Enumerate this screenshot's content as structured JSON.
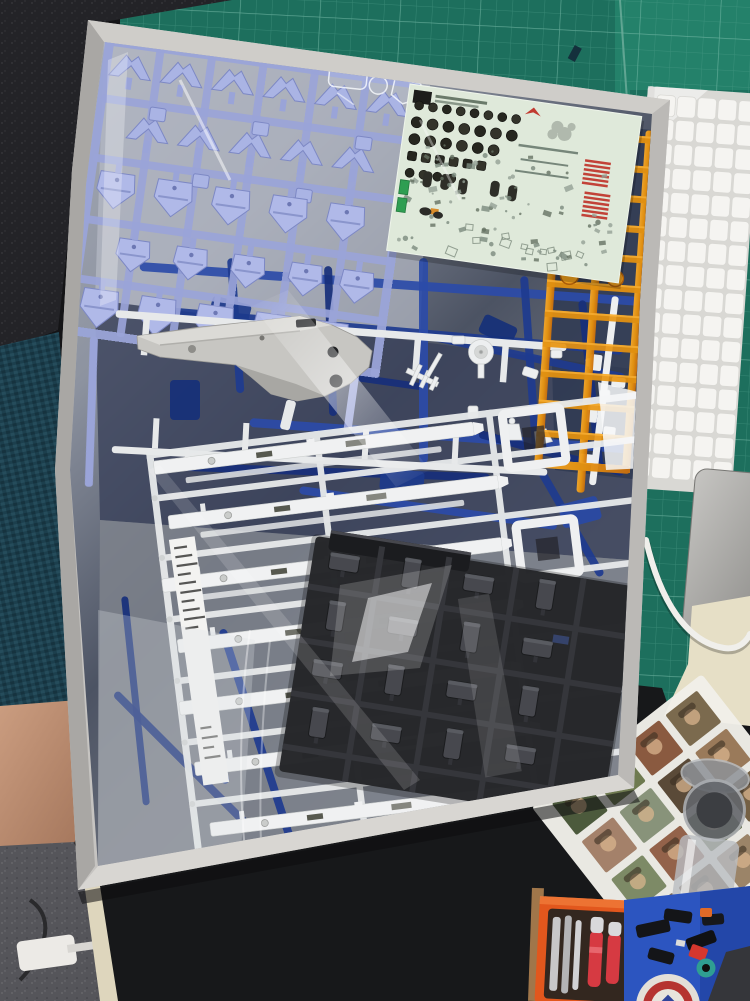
{
  "scene": {
    "alt": "Opened Gundam model kit box with bagged plastic sprues on a desk"
  },
  "palette": {
    "mat": "#1d6f5d",
    "matlight": "#27876f",
    "matline": "#4f9f8c",
    "matmajor": "#8ecab8",
    "box": "#c6c4c1",
    "boxlight": "#d8d6d2",
    "boxdark": "#a9a7a4",
    "boxrim": "#cfcdc9",
    "bag": "#8d93a0",
    "bagdark": "#39415a",
    "baglight": "#b6bbc6",
    "lav": "#9aa4d8",
    "lavlight": "#aab4e4",
    "lavfill": "#b0b9e8",
    "lavdark": "#7d88c4",
    "white": "#f0f1f2",
    "whitedim": "#e7e9ea",
    "whiteshade": "#cdd0cf",
    "gray": "#c7c6c2",
    "graylight": "#dbdad6",
    "graydark": "#a8a7a3",
    "black": "#26272a",
    "blackrail": "#35363b",
    "blackpart": "#47484e",
    "blackhl": "#5e6067",
    "decal": "#dfe9da",
    "decalink": "#2c2c24",
    "decalgray": "#7e8c7e",
    "green": "#2f9e52",
    "red": "#c24238",
    "orange": "#e8940f",
    "orangelight": "#ffb435",
    "orangedark": "#b05f08",
    "kb": "#d9d8d4",
    "key": "#f5f4f1",
    "pad": "#b5b3b0",
    "deskmat": "#17181a",
    "carpet": "#55555a",
    "chair": "#1c3f4d",
    "skin": "#c49579",
    "cream": "#ded6bd",
    "paper": "#e6dfc6",
    "photo": "#f1efe9",
    "toolcase": "#e2571d",
    "toolred": "#d63a42",
    "tray": "#2c55c0",
    "glass": "#b9bdc2",
    "wood": "#a0764a",
    "badgered": "#b53431",
    "badgeblue": "#30449a",
    "teal": "#2f9e92",
    "blues": [
      "#2b4ba8",
      "#1e3b8f",
      "#172f7b"
    ]
  },
  "keyboard": {
    "rows": 16,
    "cols": 5
  },
  "lavender": {
    "frame": {
      "w": 318,
      "h": 300,
      "vrails": [
        52,
        104,
        156,
        208,
        260
      ],
      "hrails": [
        58,
        118,
        180,
        240
      ]
    },
    "rows": [
      {
        "type": "chevron",
        "y": 14,
        "xs": [
          8,
          60,
          112,
          164,
          216,
          268
        ]
      },
      {
        "type": "chevron",
        "y": 74,
        "xs": [
          34,
          86,
          138,
          190,
          242
        ]
      },
      {
        "type": "block",
        "y": 64,
        "xs": [
          54,
          158,
          262
        ]
      },
      {
        "type": "block",
        "y": 124,
        "xs": [
          106,
          210
        ]
      },
      {
        "type": "shield",
        "y": 134,
        "xs": [
          12,
          70,
          128,
          186,
          244
        ],
        "w": 38,
        "h": 36
      },
      {
        "type": "shield",
        "y": 198,
        "xs": [
          40,
          98,
          156,
          214,
          266
        ],
        "w": 34,
        "h": 32
      },
      {
        "type": "shield",
        "y": 252,
        "xs": [
          12,
          70,
          128,
          186,
          244
        ],
        "w": 38,
        "h": 38
      }
    ]
  },
  "blue_bars": [
    [
      140,
      262,
      500,
      4,
      9,
      0
    ],
    [
      155,
      306,
      470,
      5,
      8,
      1
    ],
    [
      185,
      350,
      240,
      8,
      7,
      2
    ],
    [
      420,
      330,
      210,
      12,
      8,
      1
    ],
    [
      250,
      418,
      380,
      4,
      9,
      0
    ],
    [
      160,
      462,
      330,
      2,
      8,
      2
    ],
    [
      235,
      258,
      135,
      86,
      8,
      1
    ],
    [
      332,
      266,
      150,
      88,
      8,
      2
    ],
    [
      428,
      258,
      205,
      90,
      9,
      0
    ],
    [
      528,
      276,
      180,
      86,
      8,
      1
    ],
    [
      586,
      300,
      170,
      84,
      8,
      2
    ],
    [
      180,
      548,
      240,
      78,
      8,
      1
    ],
    [
      128,
      596,
      210,
      84,
      7,
      2
    ],
    [
      226,
      628,
      260,
      72,
      8,
      1
    ],
    [
      300,
      486,
      260,
      8,
      8,
      0
    ],
    [
      118,
      690,
      190,
      45,
      8,
      2
    ],
    [
      545,
      470,
      120,
      60,
      8,
      1
    ],
    [
      480,
      430,
      150,
      15,
      8,
      2
    ]
  ],
  "beams": [
    [
      6,
      10,
      322
    ],
    [
      14,
      66,
      332
    ],
    [
      0,
      128,
      342
    ],
    [
      8,
      190,
      338
    ],
    [
      2,
      252,
      334
    ],
    [
      10,
      314,
      338
    ],
    [
      18,
      376,
      304
    ]
  ],
  "decal_dots": [
    [
      20,
      8,
      4.5
    ],
    [
      37,
      7,
      5.5
    ],
    [
      54,
      6,
      5.5
    ],
    [
      71,
      6,
      4.5
    ],
    [
      88,
      4,
      4.5
    ]
  ],
  "decal_marks": 85,
  "black_grid": {
    "rows": 4,
    "cols": 4
  },
  "photos": {
    "rows": 6,
    "cols": 4,
    "colors": [
      "#7b6a4e",
      "#8a5a40",
      "#6e7a50",
      "#4c5a3c",
      "#9a7a5a",
      "#5a4a38",
      "#88937a",
      "#a4816a",
      "#746044",
      "#5f6b47",
      "#93624a",
      "#7d8a66",
      "#54452f",
      "#9b8468",
      "#685338",
      "#7f6b52",
      "#8f9d84",
      "#a7876e",
      "#5c4b33",
      "#756449",
      "#86553e",
      "#6b764e",
      "#97775c",
      "#4e5c40"
    ]
  }
}
